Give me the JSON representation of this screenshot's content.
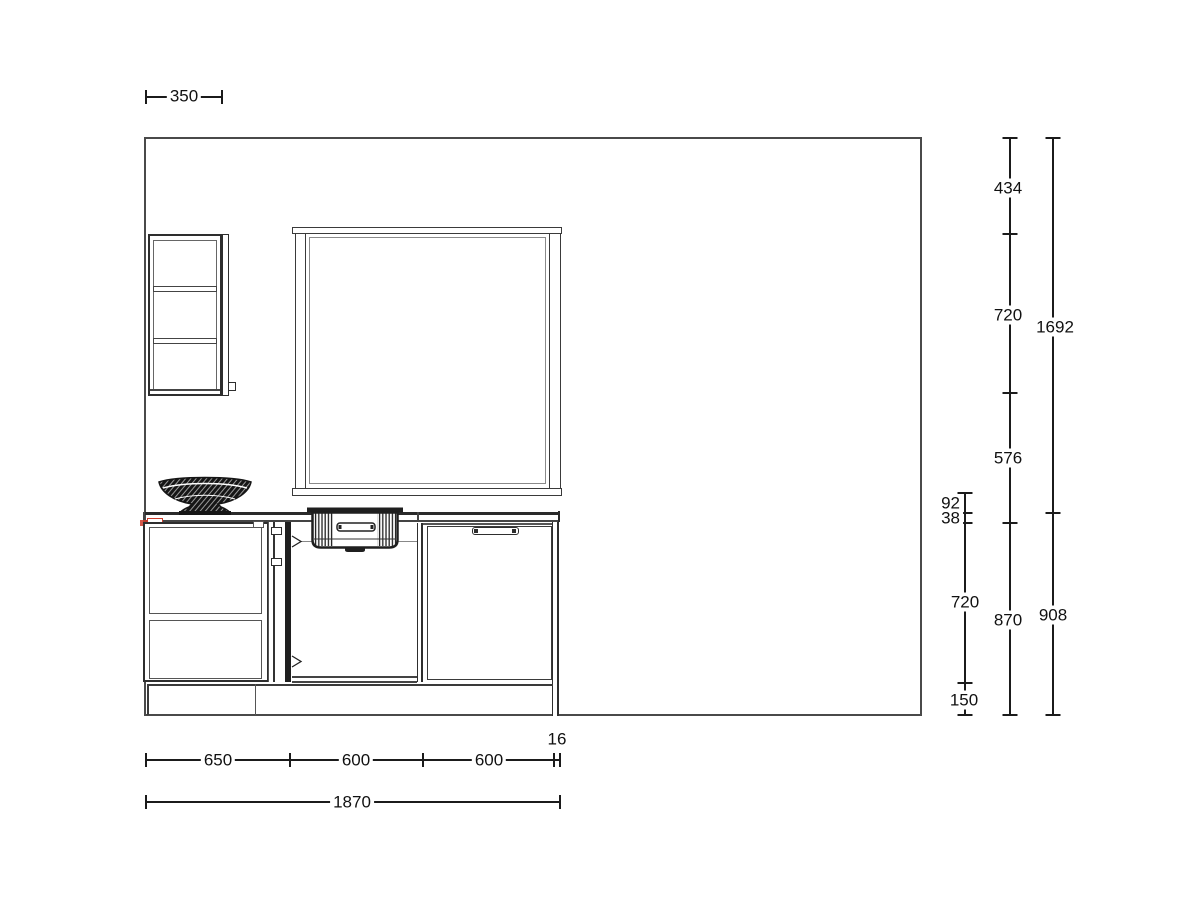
{
  "drawing": {
    "type": "kitchen-elevation",
    "colors": {
      "line": "#2e2e2e",
      "wall_line": "#4a4a4a",
      "dimension": "#1b1b1b",
      "accent_red": "#cc3b2a",
      "background": "#ffffff"
    },
    "objects": [
      "wall-cabinet",
      "window",
      "countertop",
      "fruit-bowl",
      "sink",
      "drawer-base-cabinet",
      "sink-base-cabinet",
      "door-base-cabinet",
      "plinth"
    ]
  },
  "dims": {
    "top": {
      "w350": "350"
    },
    "bottom": {
      "s650": "650",
      "s600a": "600",
      "s600b": "600",
      "s16": "16",
      "total": "1870"
    },
    "colA": {
      "d92": "92",
      "d38": "38",
      "d720": "720",
      "d150": "150"
    },
    "colB": {
      "d434": "434",
      "d720": "720",
      "d576": "576",
      "d870": "870"
    },
    "colC": {
      "d1692": "1692",
      "d908": "908"
    }
  }
}
